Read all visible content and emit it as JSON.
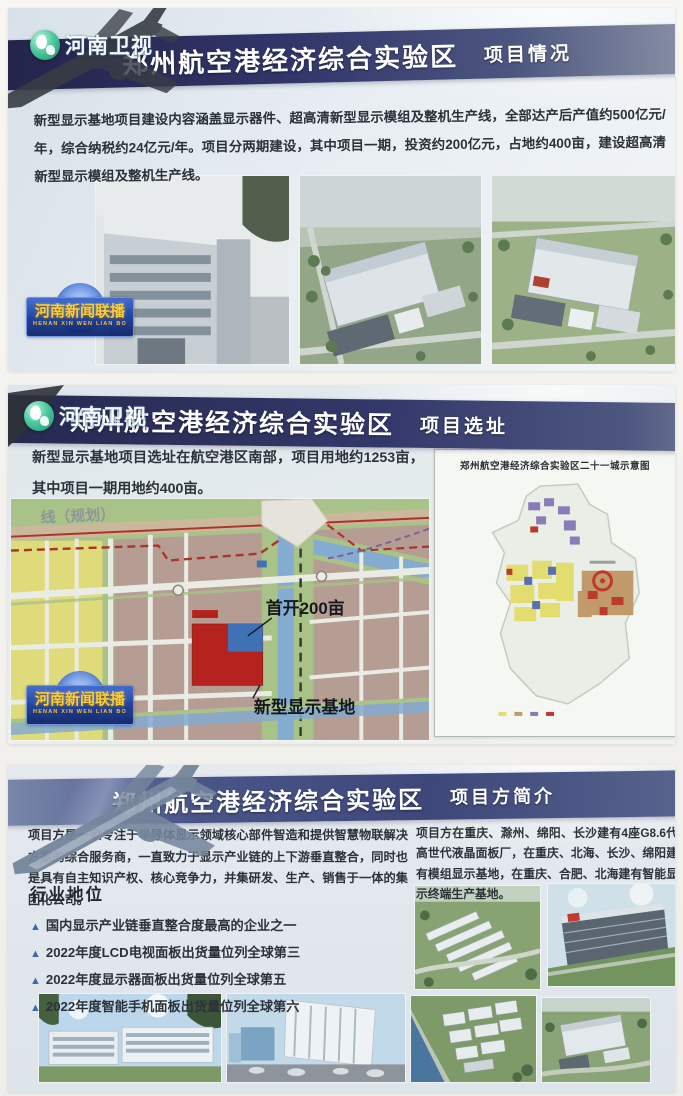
{
  "station": {
    "logo_text": "河南卫视",
    "watermark_title": "河南新闻联播",
    "watermark_subtitle": "HENAN XIN WEN LIAN BO"
  },
  "icons": {
    "bullet_marker": "▲"
  },
  "colors": {
    "header_navy": "#2c3060",
    "board_light_blue": "#e3eaf0",
    "map_parcel_red": "#b5231f",
    "map_parcel_blue": "#3f72b5",
    "map_yellow": "#dfdb7a",
    "map_green": "#a9c287",
    "map_tan": "#b29a90",
    "river_blue": "#84abd0",
    "watermark_gold": "#f0c43a",
    "tv_logo_teal": "#2fae85",
    "bullet_blue": "#3b69ad"
  },
  "panels": [
    {
      "id": "project-overview",
      "title_main": "郑州航空港经济综合实验区",
      "title_sub": "项目情况",
      "body": "新型显示基地项目建设内容涵盖显示器件、超高清新型显示模组及整机生产线，全部达产后产值约500亿元/年，综合纳税约24亿元/年。项目分两期建设，其中项目一期，投资约200亿元，占地约400亩，建设超高清新型显示模组及整机生产线。"
    },
    {
      "id": "project-site",
      "title_main": "郑州航空港经济综合实验区",
      "title_sub": "项目选址",
      "body": "新型显示基地项目选址在航空港区南部，项目用地约1253亩，其中项目一期用地约400亩。",
      "map": {
        "label_planned_line": "线（规划）",
        "label_first_phase": "首开200亩",
        "label_base": "新型显示基地",
        "inset_title": "郑州航空港经济综合实验区二十一城示意图"
      }
    },
    {
      "id": "project-party",
      "title_main": "郑州航空港经济综合实验区",
      "title_sub": "项目方简介",
      "body_left": "项目方是一家专注于半导体显示领域核心部件智造和提供智慧物联解决方案的综合服务商，一直致力于显示产业链的上下游垂直整合，同时也是具有自主知识产权、核心竞争力，并集研发、生产、销售于一体的集团化公司。",
      "body_right": "项目方在重庆、滁州、绵阳、长沙建有4座G8.6代高世代液晶面板厂，在重庆、北海、长沙、绵阳建有模组显示基地，在重庆、合肥、北海建有智能显示终端生产基地。",
      "industry": {
        "heading": "行业地位",
        "bullets": [
          "国内显示产业链垂直整合度最高的企业之一",
          "2022年度LCD电视面板出货量位列全球第三",
          "2022年度显示器面板出货量位列全球第五",
          "2022年度智能手机面板出货量位列全球第六"
        ]
      }
    }
  ]
}
